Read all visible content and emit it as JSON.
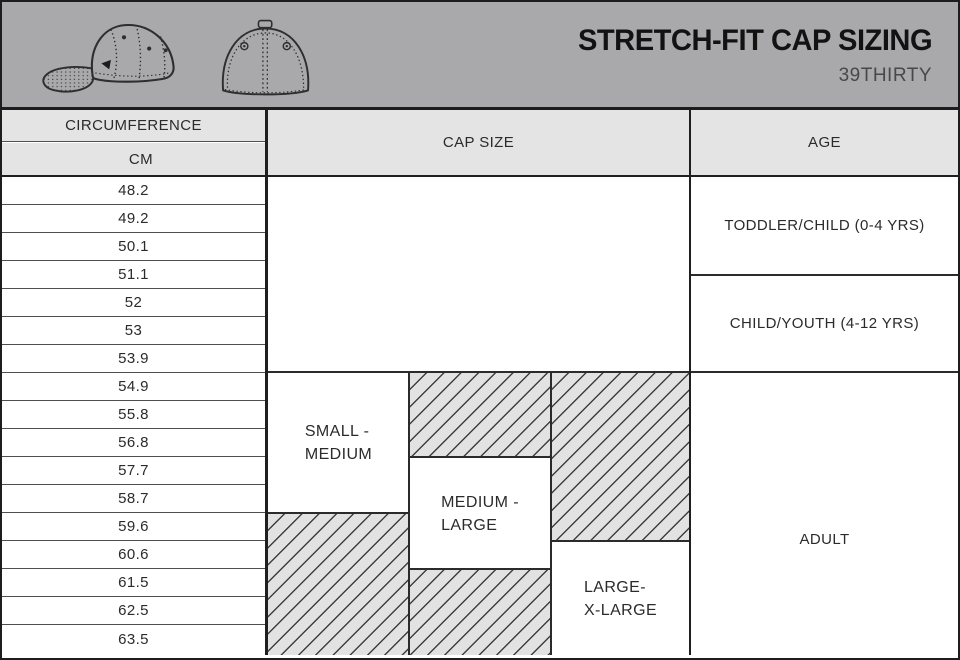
{
  "header": {
    "title": "STRETCH-FIT CAP SIZING",
    "subtitle": "39THIRTY"
  },
  "chart_data": {
    "type": "table",
    "title": "STRETCH-FIT CAP SIZING",
    "subtitle": "39THIRTY",
    "headers": {
      "circumference": "CIRCUMFERENCE",
      "unit": "CM",
      "cap_size": "CAP SIZE",
      "age": "AGE"
    },
    "circumference_cm": [
      "48.2",
      "49.2",
      "50.1",
      "51.1",
      "52",
      "53",
      "53.9",
      "54.9",
      "55.8",
      "56.8",
      "57.7",
      "58.7",
      "59.6",
      "60.6",
      "61.5",
      "62.5",
      "63.5"
    ],
    "cap_sizes": [
      {
        "label": "SMALL -\nMEDIUM",
        "solid_cm_range": [
          "54.9",
          "58.7"
        ],
        "hatched_overlap_cm_ranges": [
          [
            "59.6",
            "63.5"
          ]
        ]
      },
      {
        "label": "MEDIUM -\nLARGE",
        "solid_cm_range": [
          "57.7",
          "60.6"
        ],
        "hatched_overlap_cm_ranges": [
          [
            "54.9",
            "56.8"
          ],
          [
            "61.5",
            "63.5"
          ]
        ]
      },
      {
        "label": "LARGE-\nX-LARGE",
        "solid_cm_range": [
          "60.6",
          "63.5"
        ],
        "hatched_overlap_cm_ranges": [
          [
            "54.9",
            "59.6"
          ]
        ]
      }
    ],
    "ages": [
      {
        "label": "TODDLER/CHILD (0-4 YRS)",
        "cm_range": [
          "48.2",
          "51.1"
        ]
      },
      {
        "label": "CHILD/YOUTH (4-12 YRS)",
        "cm_range": [
          "52",
          "53.9"
        ]
      },
      {
        "label": "ADULT",
        "cm_range": [
          "54.9",
          "63.5"
        ]
      }
    ]
  },
  "colors": {
    "band_bg": "#a9a9ab",
    "header_cell_bg": "#e4e4e4",
    "hatch_bg": "#e2e2e2",
    "hatch_line": "#3f3f3f",
    "grid_thin": "#4f4f4f",
    "grid_thick": "#1f1f1f",
    "text": "#2b2b2b",
    "subtitle_text": "#48484a"
  },
  "icons": {
    "cap_side": "stretch-fit cap side view line drawing",
    "cap_back": "stretch-fit cap back view line drawing"
  }
}
